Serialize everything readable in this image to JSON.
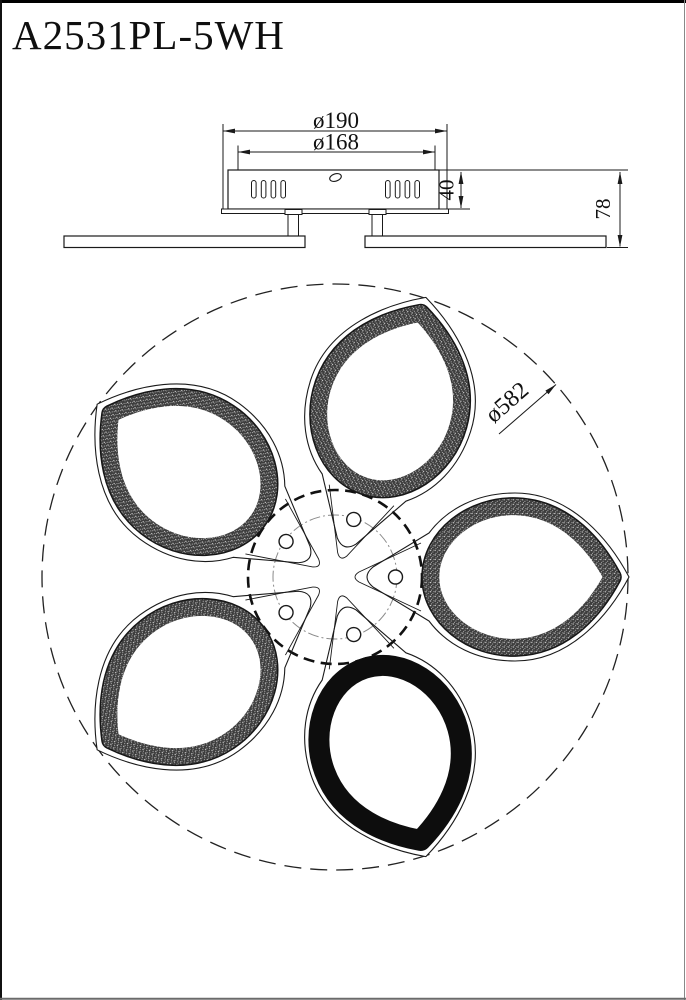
{
  "page": {
    "title": "A2531PL-5WH"
  },
  "side_view": {
    "label_outer_diameter": "ø190",
    "label_inner_diameter": "ø168",
    "label_canopy_height": "40",
    "label_total_height": "78"
  },
  "plan_view": {
    "label_overall_diameter": "ø582"
  },
  "colors": {
    "line": "#1a1a1a",
    "outer_dash_circle": "#222222",
    "hub_dash_circle": "#111111",
    "centerline_gray": "#8a8a8a"
  }
}
